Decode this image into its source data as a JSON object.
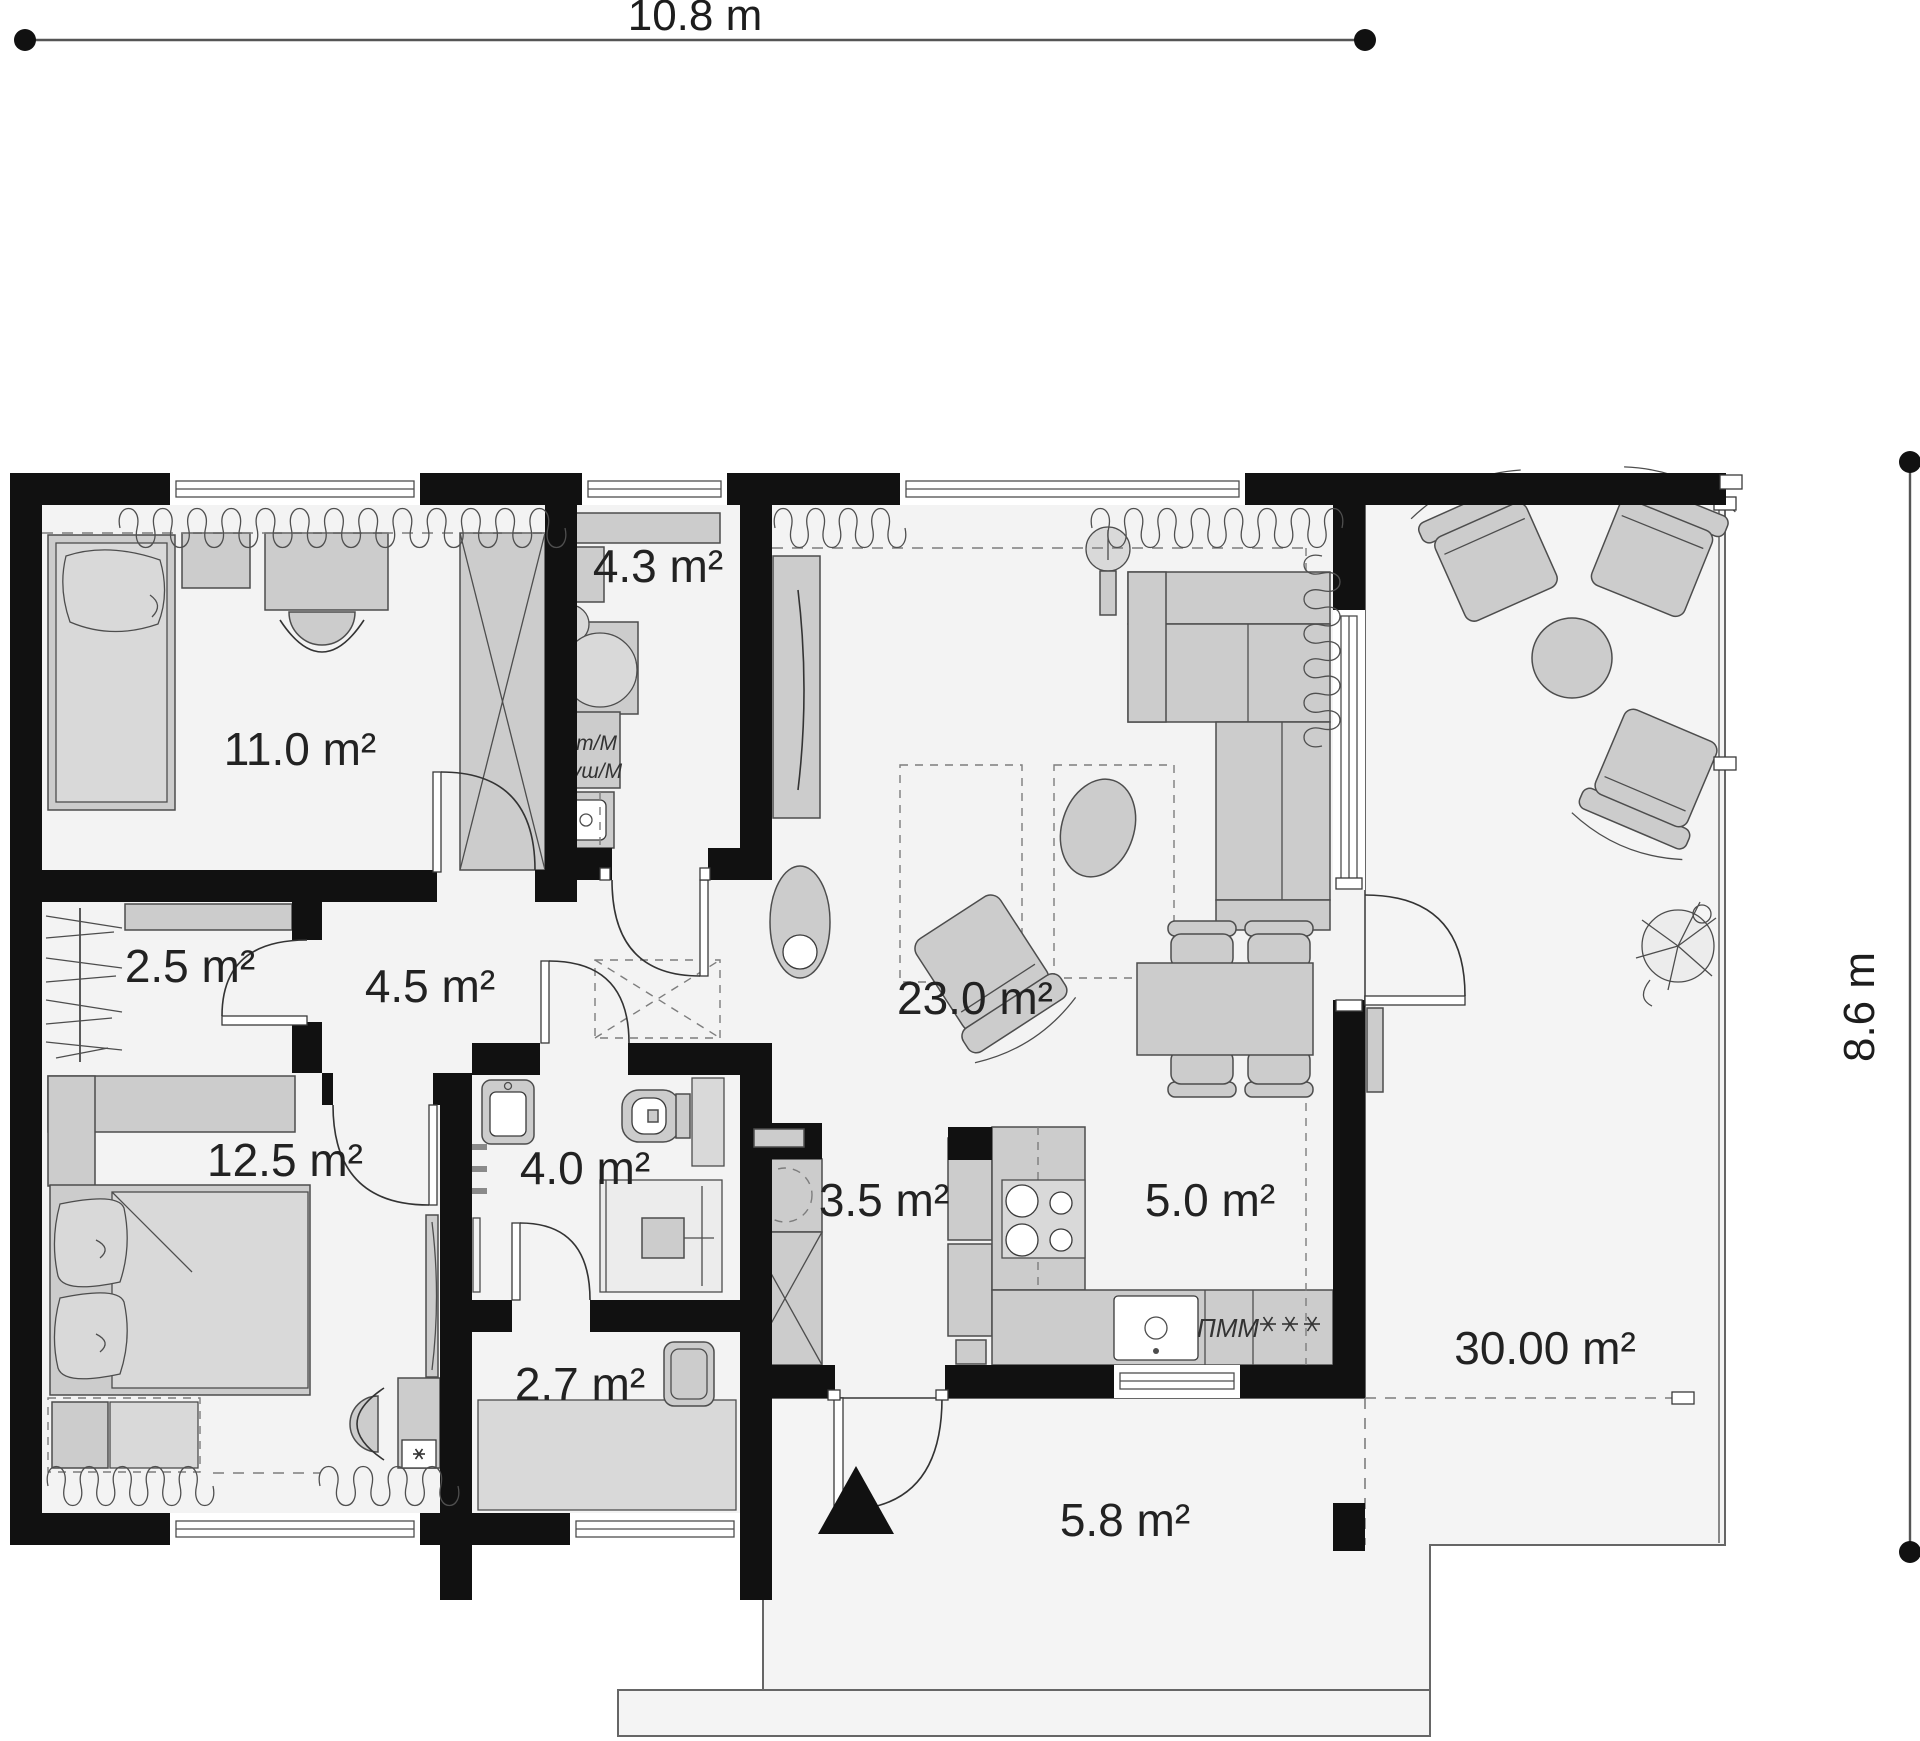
{
  "page_type": "architectural floor plan",
  "dimension_labels": {
    "top": "10.8 m",
    "right": "8.6 m"
  },
  "rooms": [
    {
      "name": "bedroom",
      "area_label": "11.0 m²"
    },
    {
      "name": "utility-room",
      "area_label": "4.3 m²"
    },
    {
      "name": "wardrobe-closet",
      "area_label": "2.5 m²"
    },
    {
      "name": "hallway",
      "area_label": "4.5 m²"
    },
    {
      "name": "living-room",
      "area_label": "23.0 m²"
    },
    {
      "name": "master-bedroom",
      "area_label": "12.5 m²"
    },
    {
      "name": "bathroom",
      "area_label": "4.0 m²"
    },
    {
      "name": "storage-room",
      "area_label": "2.7 m²"
    },
    {
      "name": "pantry-hall",
      "area_label": "3.5 m²"
    },
    {
      "name": "kitchen",
      "area_label": "5.0 m²"
    },
    {
      "name": "entrance-porch",
      "area_label": "5.8 m²"
    },
    {
      "name": "terrace",
      "area_label": "30.00 m²"
    }
  ],
  "appliance_labels": {
    "washing_machine": "Ст/М",
    "dryer": "Суш/М",
    "dishwasher": "ПММ"
  },
  "icons": {
    "freezer_symbol": "* * *",
    "mirror_symbol": "*",
    "entrance_marker": "black triangle pointing up"
  },
  "colors": {
    "wall": "#111111",
    "floor": "#f3f3f3",
    "furniture_fill": "#cccccc",
    "furniture_stroke": "#4d4d4d",
    "dashed_line": "#7d7d7d",
    "text": "#222222"
  }
}
